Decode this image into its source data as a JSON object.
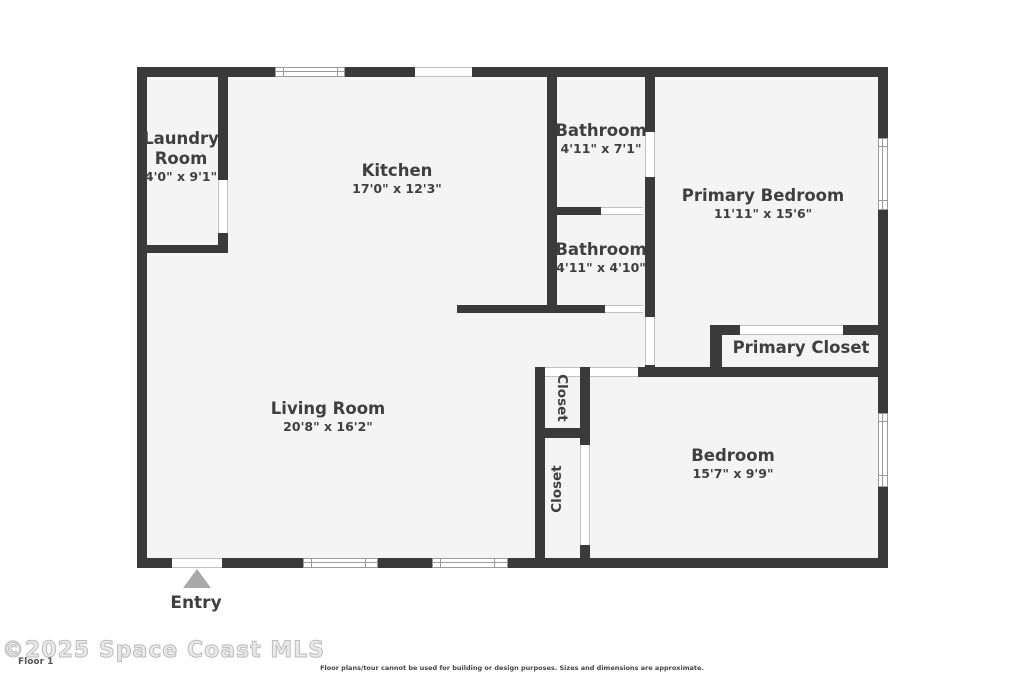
{
  "colors": {
    "wall": "#3a3a3a",
    "floor_fill": "#f4f4f4",
    "opening_fill": "#ffffff",
    "entry_arrow": "#a9a9a9",
    "label_text": "#3f3f3f",
    "watermark_gray": "#bdbdbd"
  },
  "rooms": {
    "laundry": {
      "name": "Laundry Room",
      "dims": "4'0\" x 9'1\""
    },
    "kitchen": {
      "name": "Kitchen",
      "dims": "17'0\" x 12'3\""
    },
    "bathroom_upper": {
      "name": "Bathroom",
      "dims": "4'11\" x 7'1\""
    },
    "bathroom_lower": {
      "name": "Bathroom",
      "dims": "4'11\" x 4'10\""
    },
    "primary_bedroom": {
      "name": "Primary Bedroom",
      "dims": "11'11\" x 15'6\""
    },
    "primary_closet": {
      "name": "Primary Closet"
    },
    "living_room": {
      "name": "Living Room",
      "dims": "20'8\" x 16'2\""
    },
    "bedroom": {
      "name": "Bedroom",
      "dims": "15'7\" x 9'9\""
    },
    "closet_upper": {
      "name": "Closet"
    },
    "closet_lower": {
      "name": "Closet"
    }
  },
  "entry": {
    "label": "Entry"
  },
  "footer": {
    "watermark": "©2025 Space Coast MLS",
    "floor_label": "Floor 1",
    "disclaimer": "Floor plans/tour cannot be used for building or design purposes. Sizes and dimensions are approximate."
  }
}
